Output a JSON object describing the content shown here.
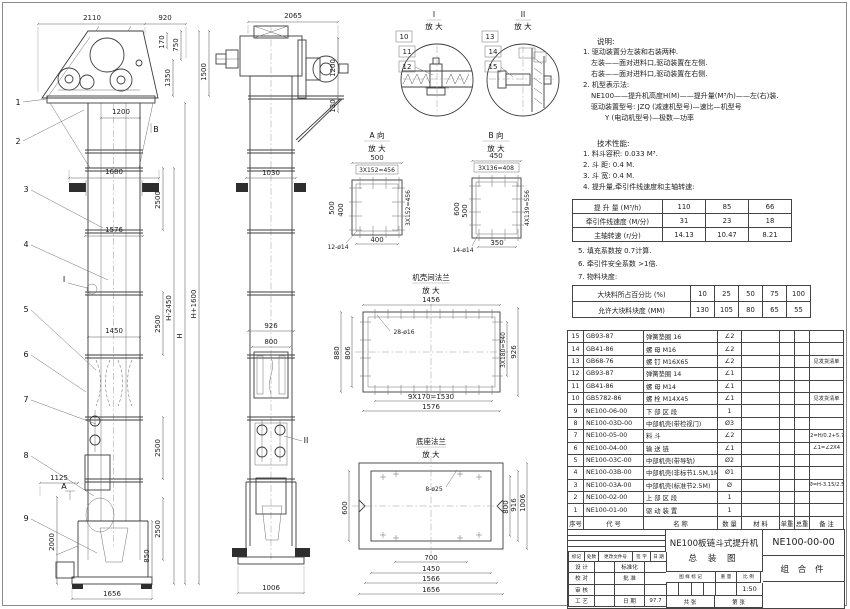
{
  "colors": {
    "background": "#ffffff",
    "line": "#3c3c3c",
    "fill_dark": "#2e2e2e"
  },
  "front_dims": [
    "2110",
    "920",
    "170",
    "750",
    "1350",
    "1500",
    "1200",
    "1680",
    "2500",
    "1576",
    "1450",
    "2500",
    "2500",
    "2500",
    "H-2450",
    "H",
    "H+1600",
    "1125",
    "2000",
    "850",
    "1656"
  ],
  "front_callouts": [
    "1",
    "2",
    "3",
    "4",
    "5",
    "6",
    "7",
    "8",
    "9"
  ],
  "front_markers": {
    "i": "I",
    "a": "A",
    "b": "B"
  },
  "side_dims": [
    "2065",
    "1200",
    "130",
    "1030",
    "926",
    "800",
    "1006"
  ],
  "side_callout": "II",
  "detail1": {
    "label": "I",
    "zoom": "放 大",
    "callouts": [
      "10",
      "11",
      "12"
    ]
  },
  "detail2": {
    "label": "II",
    "zoom": "放 大",
    "callouts": [
      "13",
      "14",
      "15"
    ]
  },
  "view_a": {
    "title": "A 向",
    "zoom": "放 大",
    "dims": [
      "500",
      "3X152=456",
      "500",
      "400",
      "3X152=456",
      "400",
      "12-ø14"
    ]
  },
  "view_b": {
    "title": "B 向",
    "zoom": "放 大",
    "dims": [
      "450",
      "3X136=408",
      "600",
      "500",
      "4X139=556",
      "350",
      "14-ø14"
    ]
  },
  "flange": {
    "title": "机壳间法兰",
    "zoom": "放 大",
    "dims": [
      "1456",
      "28-ø16",
      "880",
      "806",
      "3X180=540",
      "926",
      "9X170=1530",
      "1576"
    ]
  },
  "base_flange": {
    "title": "底座法兰",
    "zoom": "放 大",
    "dims": [
      "8-ø25",
      "600",
      "800",
      "916",
      "1006",
      "700",
      "1450",
      "1566",
      "1656"
    ]
  },
  "notes": {
    "title": "说明:",
    "lines": [
      "1. 驱动装置分左装和右装两种.",
      "左装——面对进料口,驱动装置在左侧.",
      "右装——面对进料口,驱动装置在右侧.",
      "2. 机型表示法:",
      "NE100——提升机高度H(M)——提升量(M³/h)——左(右)装.",
      "驱动装置型号: JZQ (减速机型号)—速比—机型号",
      "Y (电动机型号)—极数—功率"
    ]
  },
  "tech": {
    "title": "技术性能:",
    "items": [
      "1. 料斗容积: 0.033 M³.",
      "2. 斗  距: 0.4 M.",
      "3. 斗  宽: 0.4 M.",
      "4. 提升量,牵引件线速度和主轴转速:"
    ],
    "items2": [
      "5. 填充系数按 0.7计算.",
      "6. 牵引件安全系数 >1倍.",
      "7. 物料块度:"
    ]
  },
  "perf_table": {
    "rows": [
      [
        "提 升 量  (M³/h)",
        "110",
        "85",
        "66"
      ],
      [
        "牵引件线速度 (M/分)",
        "31",
        "23",
        "18"
      ],
      [
        "主轴转速  (r/分)",
        "14.13",
        "10.47",
        "8.21"
      ]
    ]
  },
  "lump_table": {
    "rows": [
      [
        "大块料所占百分比 (%)",
        "10",
        "25",
        "50",
        "75",
        "100"
      ],
      [
        "允许大块料块度 (MM)",
        "130",
        "105",
        "80",
        "65",
        "55"
      ]
    ]
  },
  "bom": {
    "headers": [
      [
        "序号",
        "代  号",
        "名  称",
        "数 量",
        "材  料",
        "单重",
        "总重",
        "备  注"
      ]
    ],
    "rows": [
      [
        "15",
        "GB93-87",
        "弹簧垫圈 16",
        "∠2",
        "",
        "",
        "",
        ""
      ],
      [
        "14",
        "GB41-86",
        "螺 母  M16",
        "∠2",
        "",
        "",
        "",
        ""
      ],
      [
        "13",
        "GB68-76",
        "螺 钉  M16X65",
        "∠2",
        "",
        "",
        "",
        "见发货清单"
      ],
      [
        "12",
        "GB93-87",
        "弹簧垫圈 14",
        "∠1",
        "",
        "",
        "",
        ""
      ],
      [
        "11",
        "GB41-86",
        "螺 母  M14",
        "∠1",
        "",
        "",
        "",
        ""
      ],
      [
        "10",
        "GB5782-86",
        "螺 栓  M14X45",
        "∠1",
        "",
        "",
        "",
        "见发货清单"
      ],
      [
        "9",
        "NE100-06-00",
        "下 部 区 段",
        "1",
        "",
        "",
        "",
        ""
      ],
      [
        "8",
        "NE100-03D-00",
        "中部机壳(带检视门)",
        "Ø3",
        "",
        "",
        "",
        ""
      ],
      [
        "7",
        "NE100-05-00",
        "料 斗",
        "∠2",
        "",
        "",
        "",
        "∠2=H/0.2+5.75"
      ],
      [
        "6",
        "NE100-04-00",
        "输 送 链",
        "∠1",
        "",
        "",
        "",
        "∠1=∠2X4"
      ],
      [
        "5",
        "NE100-03C-00",
        "中部机壳(带导轨)",
        "Ø2",
        "",
        "",
        "",
        ""
      ],
      [
        "4",
        "NE100-03B-00",
        "中部机壳(非标节1.5M,1M)",
        "Ø1",
        "",
        "",
        "",
        ""
      ],
      [
        "3",
        "NE100-03A-00",
        "中部机壳(标准节2.5M)",
        "Ø",
        "",
        "",
        "",
        "Ø=H-3.15/2.5"
      ],
      [
        "2",
        "NE100-02-00",
        "上 部 区 段",
        "1",
        "",
        "",
        "",
        ""
      ],
      [
        "1",
        "NE100-01-00",
        "驱 动 装 置",
        "1",
        "",
        "",
        "",
        ""
      ]
    ]
  },
  "titleblock": {
    "rev_header": [
      [
        "标记",
        "处数",
        "更改文件号",
        "签 字",
        "日 期"
      ]
    ],
    "roles": [
      [
        "设 计",
        "",
        "标准化",
        ""
      ],
      [
        "校 对",
        "",
        "批 准",
        ""
      ],
      [
        "审 核",
        "",
        "",
        ""
      ],
      [
        "工 艺",
        "",
        "日 期",
        "97.7"
      ]
    ],
    "title1": "NE100板链斗式提升机",
    "title2": "总  装  图",
    "stamp_header": [
      [
        "图 样 标 记",
        "重 量",
        "比 例"
      ]
    ],
    "scale": "1:50",
    "sheet_left": "共    张",
    "sheet_right": "第    张",
    "drawing_no": "NE100-00-00",
    "part_class": "组 合 件"
  }
}
